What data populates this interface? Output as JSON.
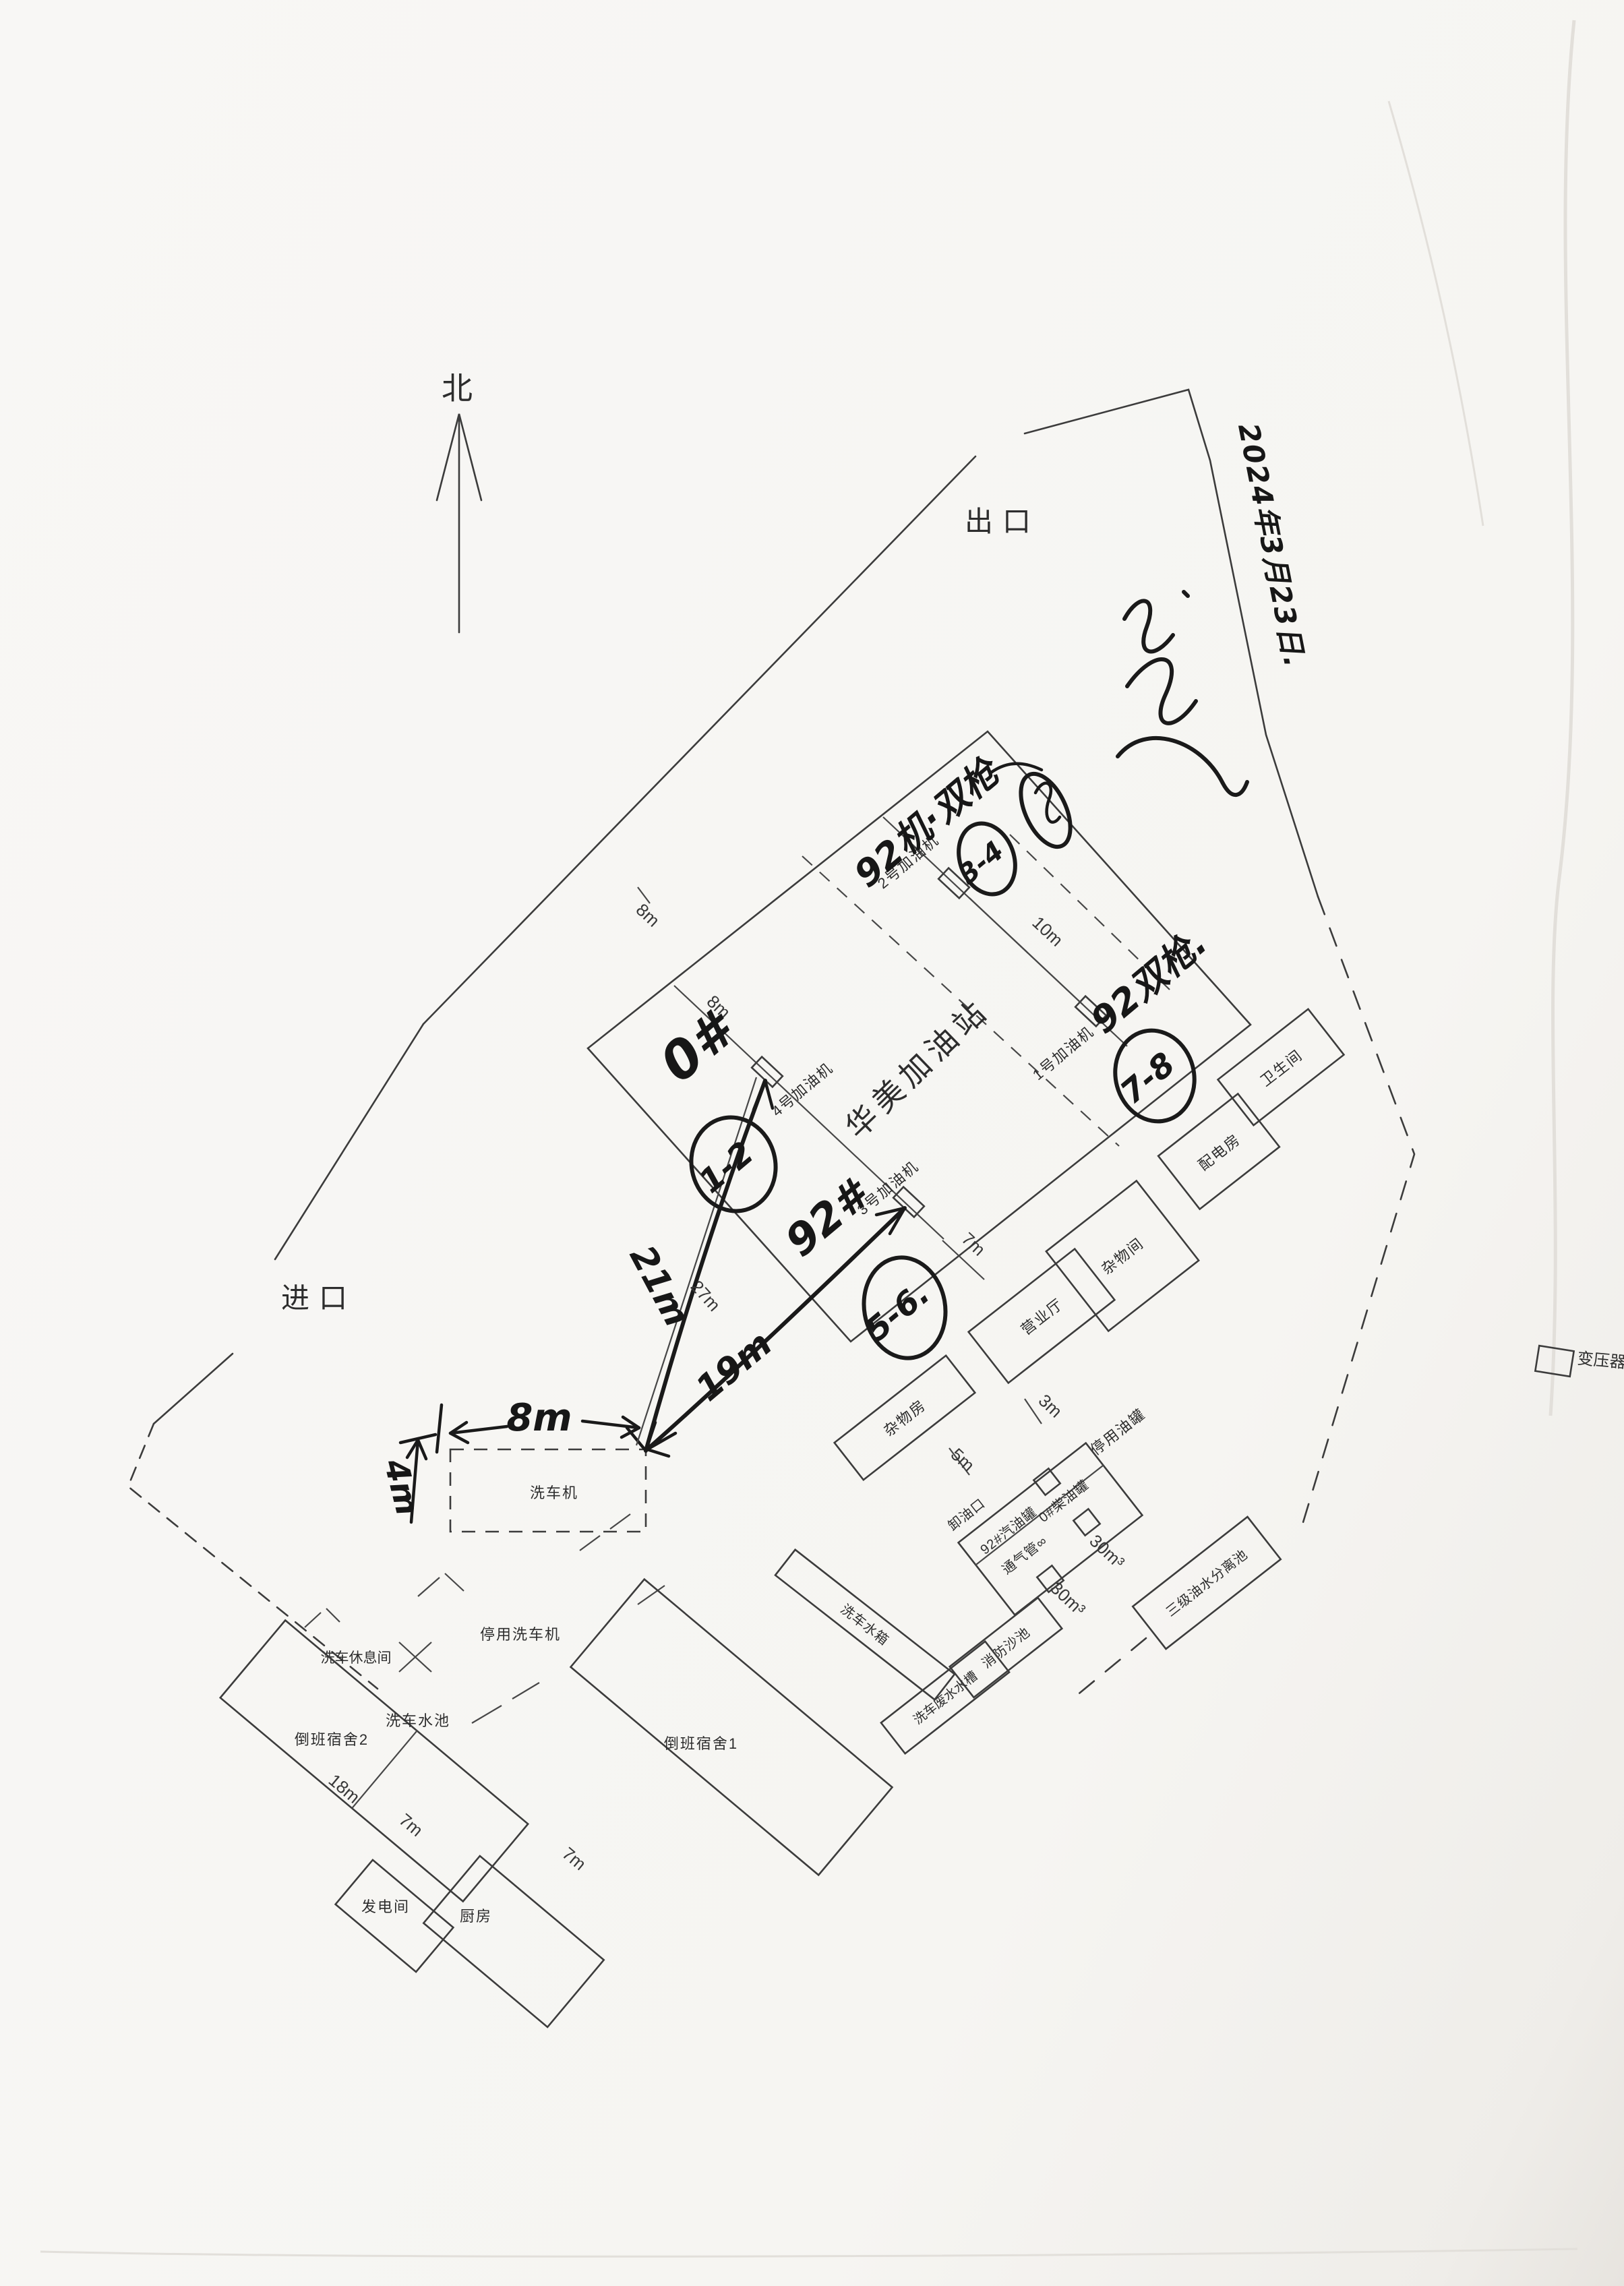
{
  "compass": {
    "north": "北"
  },
  "access": {
    "exit": "出口",
    "entrance": "进口"
  },
  "station": {
    "name": "华美加油站"
  },
  "pumps": {
    "p1": "1号加油机",
    "p2": "2号加油机",
    "p3": "3号加油机",
    "p4": "4号加油机"
  },
  "buildings": {
    "restroom": "卫生间",
    "power_room": "配电房",
    "sundry_room": "杂物间",
    "business_hall": "营业厅",
    "junk_room": "杂物房",
    "disused_tank": "停用油罐",
    "unload_port": "卸油口",
    "gasoline_tank": "92#汽油罐",
    "diesel_tank": "0#柴油罐",
    "vent_pipe": "通气管∞",
    "fire_sand_pool": "消防沙池",
    "washwater_tank": "洗车废水水槽",
    "separator_pool": "三级油水分离池",
    "carwash_water_tank": "洗车水箱",
    "dorm1": "倒班宿舍1",
    "dorm2": "倒班宿舍2",
    "generator_room": "发电间",
    "kitchen": "厨房",
    "carwash_rest_room": "洗车休息间",
    "carwash_pool": "洗车水池",
    "disused_washer": "停用洗车机",
    "washer": "洗车机",
    "transformer": "变压器"
  },
  "measurements": {
    "canopy_8m_a": "8m",
    "canopy_8m_b": "8m",
    "pump_gap_10m": "10m",
    "hall_gap_7m": "7m",
    "tank_gap_3m": "3m",
    "unload_gap_5m": "5m",
    "washer_to_pump4_27m": "27m",
    "dorm2_18m": "18m",
    "dorm2_gap_7m": "7m",
    "kitchen_7m": "7m",
    "tank_volume_a": "30m³",
    "tank_volume_b": "30m³"
  },
  "handwritten": {
    "date": "2024年3月23日.",
    "pump2_note": "92机·双枪",
    "pump1_note": "92双枪.",
    "pump4_note": "0#",
    "pump3_note": "92#",
    "nozzle_circle_p4": "1-2",
    "nozzle_circle_p2": "3-4",
    "nozzle_circle_p3": "5-6.",
    "nozzle_circle_p1": "7-8",
    "washer_width_8m": "8m",
    "washer_to_pump4_21m": "21m",
    "washer_to_pump3_19m": "19m",
    "washer_height_4m": "4m"
  }
}
